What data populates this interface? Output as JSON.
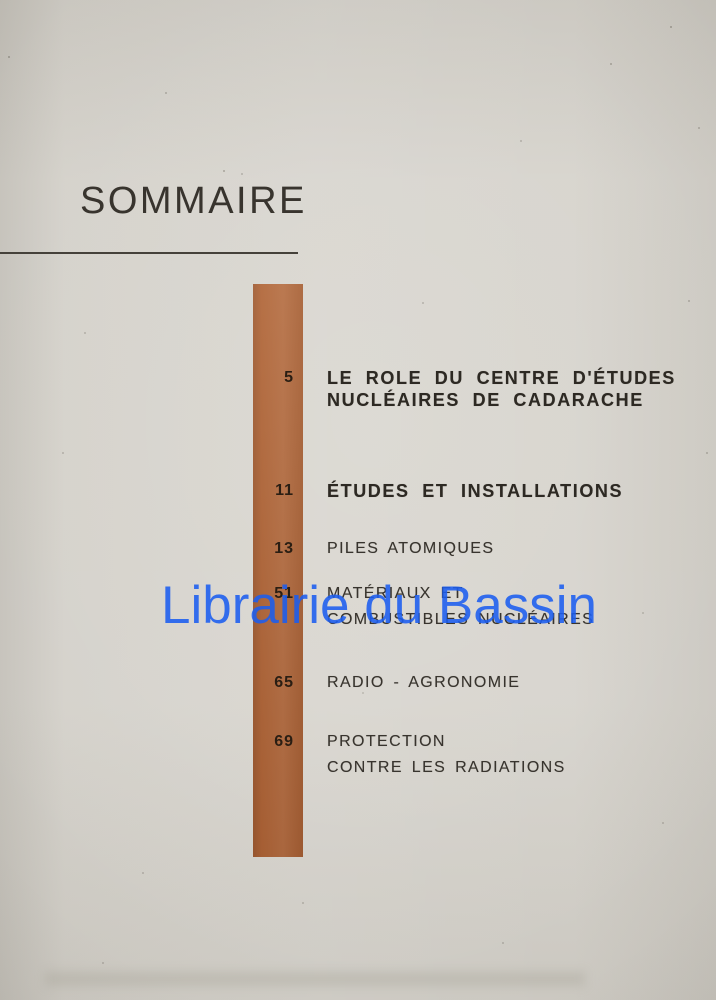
{
  "page_title": "SOMMAIRE",
  "watermark_text": "Librairie du Bassin",
  "colors": {
    "paper": "#d5d2cb",
    "bar": "#ae6336",
    "ink": "#38342e",
    "ink_bold": "#2d2923",
    "number_ink": "#2a1e13",
    "watermark": "#1c5ef0",
    "rule": "#45413a"
  },
  "toc": {
    "entries": [
      {
        "page": "5",
        "emphasis": "bold",
        "lines": [
          "LE ROLE DU CENTRE D'ÉTUDES",
          "NUCLÉAIRES DE CADARACHE"
        ]
      },
      {
        "page": "11",
        "emphasis": "bold",
        "lines": [
          "ÉTUDES ET INSTALLATIONS"
        ]
      },
      {
        "page": "13",
        "emphasis": "regular",
        "lines": [
          "PILES ATOMIQUES"
        ]
      },
      {
        "page": "51",
        "emphasis": "regular",
        "lines": [
          "MATÉRIAUX ET",
          "COMBUSTIBLES NUCLÉAIRES"
        ]
      },
      {
        "page": "65",
        "emphasis": "regular",
        "lines": [
          "RADIO - AGRONOMIE"
        ]
      },
      {
        "page": "69",
        "emphasis": "regular",
        "lines": [
          "PROTECTION",
          "CONTRE LES RADIATIONS"
        ]
      }
    ]
  }
}
